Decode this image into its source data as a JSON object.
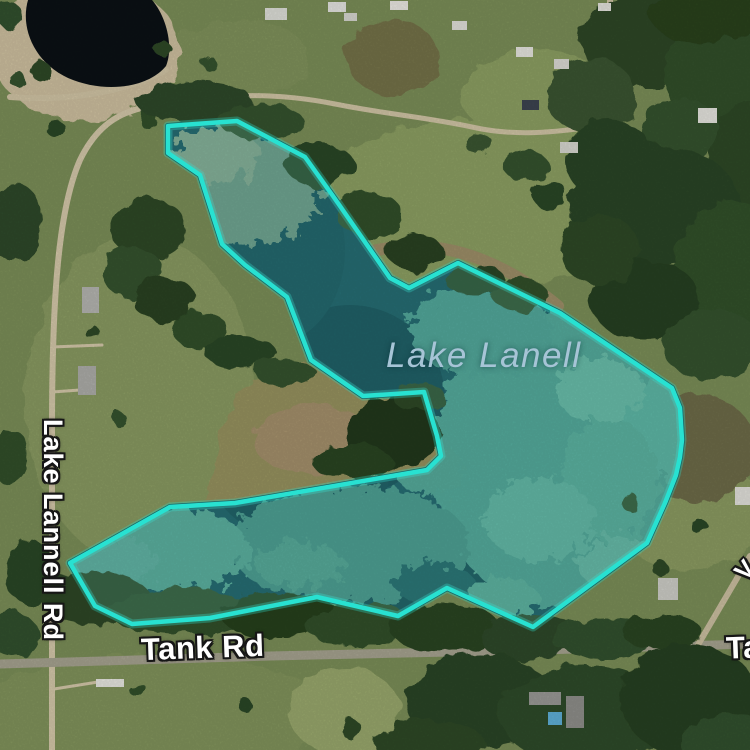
{
  "map": {
    "view_type": "satellite",
    "labels": {
      "lake": "Lake Lanell",
      "left_road": "Lake Lannell Rd",
      "bottom_road": "Tank Rd",
      "bottom_right_road_partial": "Ta",
      "right_edge_label_partial": "V"
    },
    "colors": {
      "boundary_stroke": "#28e1d1",
      "boundary_glow": "rgba(46,230,213,0.30)",
      "boundary_fill": "rgba(110,236,223,0.16)",
      "water_dark": "#16505a",
      "water_shore": "#0d3a40",
      "water_algae": "#4e9a8b",
      "lake_label": "#a6c4d6",
      "road_label": "#ffffff",
      "field_green": "#7c8f58",
      "tree_green": "#2e4628",
      "dirt_road_tan": "#d6caab",
      "paved_road_gray": "#a7a491",
      "pond_dark": "#0b1115"
    }
  },
  "overlay": {
    "kind": "lake-boundary-polygon",
    "points": "168,126 237,121 305,157 333,196 390,278 409,288 458,263 560,313 660,380 672,388 680,408 682,440 680,457 676,475 665,503 647,543 533,627 447,588 398,616 317,597 210,618 132,624 95,606 70,563 170,507 235,503 427,470 441,456 437,436 424,392 363,396 311,360 287,297 245,265 222,244 200,175 168,153"
  }
}
